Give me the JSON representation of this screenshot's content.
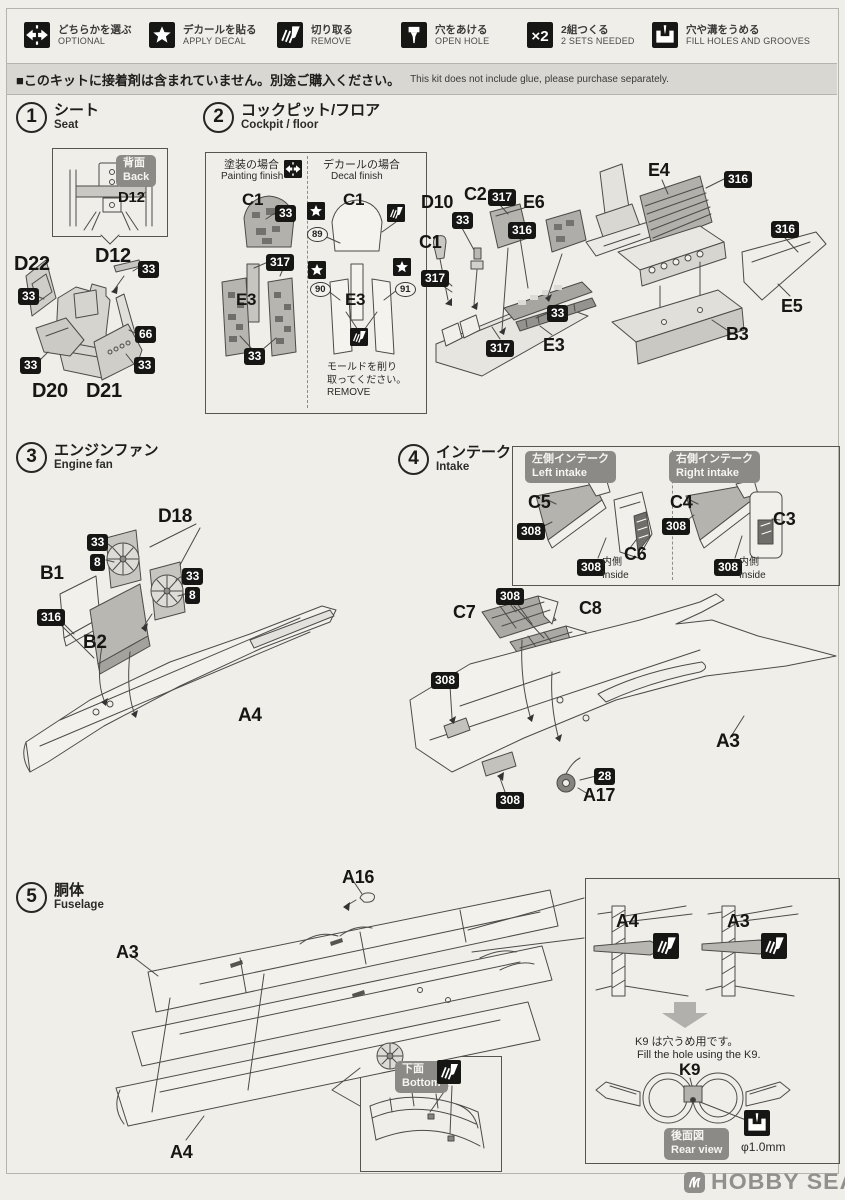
{
  "legend": {
    "items": [
      {
        "icon": "optional-icon",
        "jp": "どちらかを選ぶ",
        "en": "OPTIONAL"
      },
      {
        "icon": "decal-icon",
        "jp": "デカールを貼る",
        "en": "APPLY DECAL"
      },
      {
        "icon": "remove-icon",
        "jp": "切り取る",
        "en": "REMOVE"
      },
      {
        "icon": "open-hole-icon",
        "jp": "穴をあける",
        "en": "OPEN HOLE"
      },
      {
        "icon": "x2-icon",
        "jp": "2組つくる",
        "en": "2 SETS NEEDED"
      },
      {
        "icon": "fill-icon",
        "jp": "穴や溝をうめる",
        "en": "FILL HOLES AND GROOVES"
      }
    ]
  },
  "notice": {
    "jp": "■このキットに接着剤は含まれていません。別途ご購入ください。",
    "en": "This kit does not include glue, please purchase separately."
  },
  "steps": [
    {
      "num": "1",
      "jp": "シート",
      "en": "Seat"
    },
    {
      "num": "2",
      "jp": "コックピット/フロア",
      "en": "Cockpit / floor"
    },
    {
      "num": "3",
      "jp": "エンジンファン",
      "en": "Engine fan"
    },
    {
      "num": "4",
      "jp": "インテーク",
      "en": "Intake"
    },
    {
      "num": "5",
      "jp": "胴体",
      "en": "Fuselage"
    }
  ],
  "callouts": {
    "s1": [
      {
        "k": "graybadge",
        "jp": "背面",
        "en": "Back",
        "x": 116,
        "y": 155
      },
      {
        "k": "part",
        "t": "D12",
        "x": 118,
        "y": 189,
        "s": 15
      },
      {
        "k": "part",
        "t": "D12",
        "x": 95,
        "y": 245,
        "s": 20
      },
      {
        "k": "badge",
        "t": "33",
        "x": 139,
        "y": 262
      },
      {
        "k": "part",
        "t": "D22",
        "x": 14,
        "y": 253,
        "s": 20
      },
      {
        "k": "badge",
        "t": "33",
        "x": 19,
        "y": 289
      },
      {
        "k": "badge",
        "t": "66",
        "x": 136,
        "y": 327
      },
      {
        "k": "badge",
        "t": "33",
        "x": 21,
        "y": 358
      },
      {
        "k": "badge",
        "t": "33",
        "x": 135,
        "y": 358
      },
      {
        "k": "part",
        "t": "D20",
        "x": 32,
        "y": 380,
        "s": 20
      },
      {
        "k": "part",
        "t": "D21",
        "x": 86,
        "y": 380,
        "s": 20
      }
    ],
    "s2": [
      {
        "k": "note",
        "t": "塗装の場合",
        "x": 224,
        "y": 159,
        "s": 11
      },
      {
        "k": "note",
        "t": "Painting finish",
        "x": 221,
        "y": 171,
        "s": 10
      },
      {
        "k": "icon",
        "icon": "optional-icon",
        "x": 284,
        "y": 160
      },
      {
        "k": "note",
        "t": "デカールの場合",
        "x": 323,
        "y": 159,
        "s": 11
      },
      {
        "k": "note",
        "t": "Decal finish",
        "x": 331,
        "y": 171,
        "s": 10
      },
      {
        "k": "part",
        "t": "C1",
        "x": 242,
        "y": 190,
        "s": 17
      },
      {
        "k": "badge",
        "t": "33",
        "x": 276,
        "y": 206
      },
      {
        "k": "badge",
        "t": "317",
        "x": 267,
        "y": 255
      },
      {
        "k": "part",
        "t": "E3",
        "x": 236,
        "y": 290,
        "s": 17
      },
      {
        "k": "badge",
        "t": "33",
        "x": 245,
        "y": 349
      },
      {
        "k": "icon",
        "icon": "decal-icon",
        "x": 307,
        "y": 202
      },
      {
        "k": "part",
        "t": "C1",
        "x": 343,
        "y": 190,
        "s": 17
      },
      {
        "k": "icon",
        "icon": "remove-icon",
        "x": 387,
        "y": 204
      },
      {
        "k": "circled",
        "t": "89",
        "x": 307,
        "y": 227
      },
      {
        "k": "icon",
        "icon": "decal-icon",
        "x": 308,
        "y": 261
      },
      {
        "k": "icon",
        "icon": "decal-icon",
        "x": 393,
        "y": 258
      },
      {
        "k": "circled",
        "t": "90",
        "x": 310,
        "y": 282
      },
      {
        "k": "circled",
        "t": "91",
        "x": 395,
        "y": 282
      },
      {
        "k": "part",
        "t": "E3",
        "x": 345,
        "y": 290,
        "s": 17
      },
      {
        "k": "icon",
        "icon": "remove-icon",
        "x": 350,
        "y": 328
      },
      {
        "k": "note",
        "t": "モールドを削り\n取ってください。\nREMOVE",
        "x": 327,
        "y": 362,
        "s": 10
      },
      {
        "k": "part",
        "t": "D10",
        "x": 421,
        "y": 192
      },
      {
        "k": "part",
        "t": "C2",
        "x": 464,
        "y": 184
      },
      {
        "k": "badge",
        "t": "317",
        "x": 489,
        "y": 190
      },
      {
        "k": "part",
        "t": "E6",
        "x": 523,
        "y": 192
      },
      {
        "k": "badge",
        "t": "33",
        "x": 453,
        "y": 213
      },
      {
        "k": "badge",
        "t": "316",
        "x": 509,
        "y": 223
      },
      {
        "k": "part",
        "t": "C1",
        "x": 419,
        "y": 232
      },
      {
        "k": "badge",
        "t": "317",
        "x": 422,
        "y": 271
      },
      {
        "k": "badge",
        "t": "33",
        "x": 548,
        "y": 306
      },
      {
        "k": "part",
        "t": "E3",
        "x": 543,
        "y": 335
      },
      {
        "k": "badge",
        "t": "317",
        "x": 487,
        "y": 341
      },
      {
        "k": "part",
        "t": "E4",
        "x": 648,
        "y": 160
      },
      {
        "k": "badge",
        "t": "316",
        "x": 725,
        "y": 172
      },
      {
        "k": "badge",
        "t": "316",
        "x": 772,
        "y": 222
      },
      {
        "k": "part",
        "t": "E5",
        "x": 781,
        "y": 296
      },
      {
        "k": "part",
        "t": "B3",
        "x": 726,
        "y": 324
      }
    ],
    "s3": [
      {
        "k": "part",
        "t": "D18",
        "x": 158,
        "y": 506,
        "s": 19
      },
      {
        "k": "badge",
        "t": "33",
        "x": 88,
        "y": 535
      },
      {
        "k": "badge",
        "t": "8",
        "x": 91,
        "y": 555
      },
      {
        "k": "badge",
        "t": "33",
        "x": 183,
        "y": 569
      },
      {
        "k": "badge",
        "t": "8",
        "x": 186,
        "y": 588
      },
      {
        "k": "part",
        "t": "B1",
        "x": 40,
        "y": 563,
        "s": 19
      },
      {
        "k": "badge",
        "t": "316",
        "x": 38,
        "y": 610
      },
      {
        "k": "part",
        "t": "B2",
        "x": 83,
        "y": 632,
        "s": 19
      },
      {
        "k": "part",
        "t": "A4",
        "x": 238,
        "y": 705,
        "s": 19
      }
    ],
    "s4": [
      {
        "k": "graybadge",
        "jp": "左側インテーク",
        "en": "Left intake",
        "x": 525,
        "y": 451
      },
      {
        "k": "graybadge",
        "jp": "右側インテーク",
        "en": "Right intake",
        "x": 669,
        "y": 451
      },
      {
        "k": "part",
        "t": "C5",
        "x": 528,
        "y": 492
      },
      {
        "k": "badge",
        "t": "308",
        "x": 518,
        "y": 524
      },
      {
        "k": "part",
        "t": "C6",
        "x": 624,
        "y": 544
      },
      {
        "k": "badge",
        "t": "308",
        "x": 578,
        "y": 560
      },
      {
        "k": "note",
        "t": "内側\nInside",
        "x": 602,
        "y": 557,
        "s": 10
      },
      {
        "k": "part",
        "t": "C4",
        "x": 670,
        "y": 492
      },
      {
        "k": "badge",
        "t": "308",
        "x": 663,
        "y": 519
      },
      {
        "k": "part",
        "t": "C3",
        "x": 773,
        "y": 509
      },
      {
        "k": "badge",
        "t": "308",
        "x": 715,
        "y": 560
      },
      {
        "k": "note",
        "t": "内側\nInside",
        "x": 739,
        "y": 557,
        "s": 10
      },
      {
        "k": "badge",
        "t": "308",
        "x": 497,
        "y": 589
      },
      {
        "k": "part",
        "t": "C7",
        "x": 453,
        "y": 602
      },
      {
        "k": "part",
        "t": "C8",
        "x": 579,
        "y": 598
      },
      {
        "k": "badge",
        "t": "308",
        "x": 432,
        "y": 673
      },
      {
        "k": "badge",
        "t": "308",
        "x": 497,
        "y": 793
      },
      {
        "k": "badge",
        "t": "28",
        "x": 595,
        "y": 769
      },
      {
        "k": "part",
        "t": "A17",
        "x": 583,
        "y": 785
      },
      {
        "k": "part",
        "t": "A3",
        "x": 716,
        "y": 731,
        "s": 19
      }
    ],
    "s5": [
      {
        "k": "part",
        "t": "A16",
        "x": 342,
        "y": 867
      },
      {
        "k": "part",
        "t": "A3",
        "x": 116,
        "y": 942
      },
      {
        "k": "part",
        "t": "A4",
        "x": 170,
        "y": 1142
      },
      {
        "k": "graybadge",
        "jp": "下面",
        "en": "Bottom",
        "x": 395,
        "y": 1061
      },
      {
        "k": "icon",
        "icon": "remove-icon",
        "x": 437,
        "y": 1060,
        "w": 24
      },
      {
        "k": "part",
        "t": "A4",
        "x": 616,
        "y": 911
      },
      {
        "k": "icon",
        "icon": "remove-icon",
        "x": 653,
        "y": 933,
        "w": 26
      },
      {
        "k": "part",
        "t": "A3",
        "x": 727,
        "y": 911
      },
      {
        "k": "icon",
        "icon": "remove-icon",
        "x": 761,
        "y": 933,
        "w": 26
      },
      {
        "k": "icon",
        "icon": "arrow-down-icon",
        "x": 662,
        "y": 1002,
        "w": 46
      },
      {
        "k": "note",
        "t": "K9 は穴うめ用です。",
        "x": 635,
        "y": 1036,
        "s": 11
      },
      {
        "k": "note",
        "t": "Fill the hole using the K9.",
        "x": 637,
        "y": 1049,
        "s": 11
      },
      {
        "k": "part",
        "t": "K9",
        "x": 679,
        "y": 1060,
        "s": 17
      },
      {
        "k": "graybadge",
        "jp": "後面図",
        "en": "Rear view",
        "x": 664,
        "y": 1128
      },
      {
        "k": "icon",
        "icon": "fill-icon",
        "x": 744,
        "y": 1110,
        "w": 26
      },
      {
        "k": "note",
        "t": "φ1.0mm",
        "x": 741,
        "y": 1140,
        "s": 12
      }
    ]
  },
  "watermark": {
    "text": "HOBBY SEARCH"
  }
}
